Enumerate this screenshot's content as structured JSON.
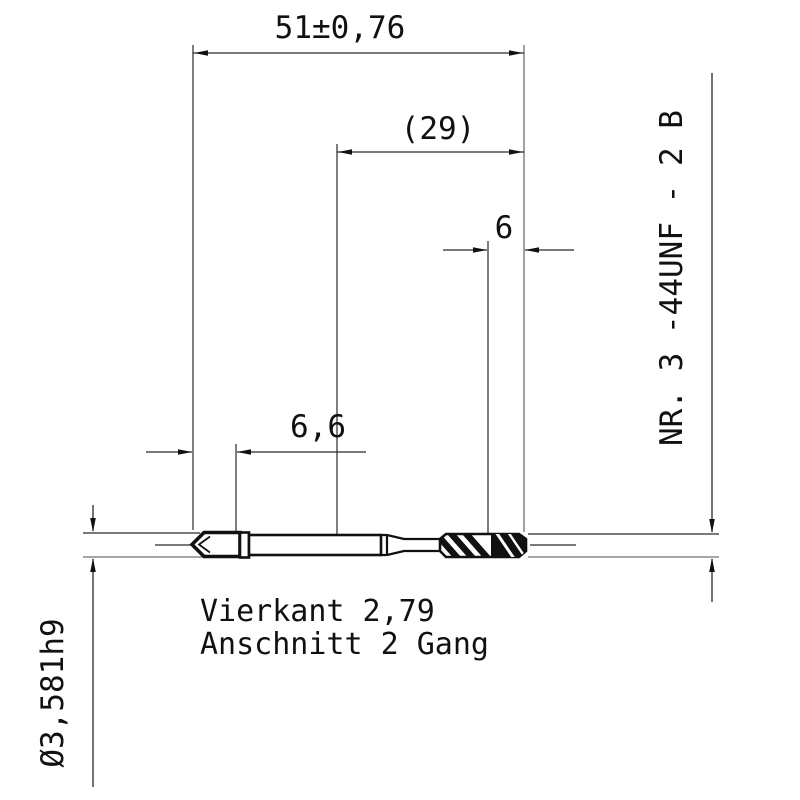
{
  "page": {
    "background": "#ffffff"
  },
  "colors": {
    "line": "#1a1a1a",
    "extension_line_gray": "#8a8a8a",
    "text": "#111111"
  },
  "labels": {
    "overall_length": "51±0,76",
    "ref_length": "(29)",
    "chamfer_length": "6",
    "square_length": "6,6",
    "shank_diameter": "Ø3,581h9",
    "thread_callout": "NR. 3  -44UNF - 2 B",
    "note_line1": "Vierkant 2,79",
    "note_line2": "Anschnitt 2 Gang"
  }
}
